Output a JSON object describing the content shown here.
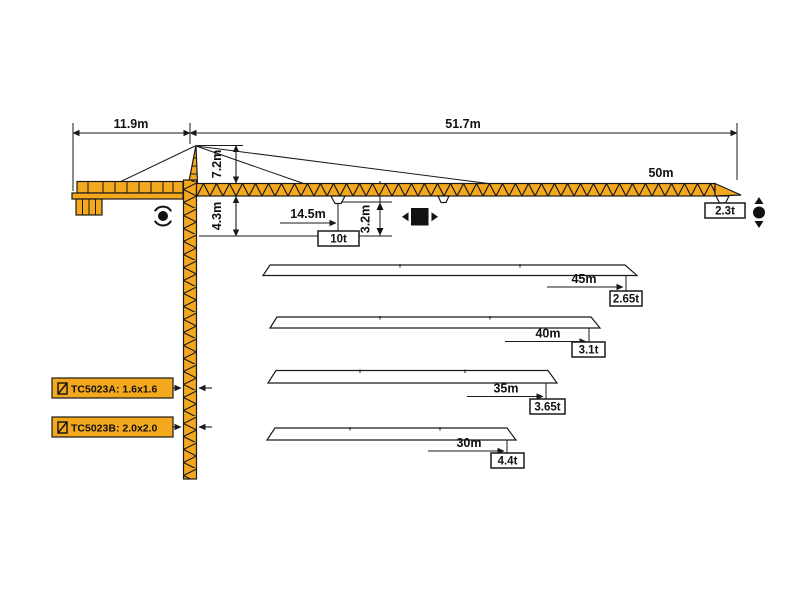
{
  "diagram": {
    "dims": {
      "counter_jib_radius": "11.9m",
      "working_radius": "51.7m",
      "tower_head_height": "7.2m",
      "jib_underside_height": "4.3m",
      "min_radius": "14.5m",
      "hook_path_height": "3.2m"
    },
    "main_jib": {
      "length_label": "50m",
      "max_capacity": "10t",
      "tip_capacity": "2.3t"
    },
    "jib_variants": [
      {
        "length_label": "45m",
        "tip_capacity": "2.65t"
      },
      {
        "length_label": "40m",
        "tip_capacity": "3.1t"
      },
      {
        "length_label": "35m",
        "tip_capacity": "3.65t"
      },
      {
        "length_label": "30m",
        "tip_capacity": "4.4t"
      }
    ],
    "mast_sections": [
      {
        "label": "TC5023A: 1.6x1.6"
      },
      {
        "label": "TC5023B: 2.0x2.0"
      }
    ],
    "icons": {
      "slewing": "dot-with-rotation-arcs",
      "trolley_travel": "black-square-with-left-right-arrows",
      "hoist": "black-circle-with-up-down-arrows",
      "mast_section": "small-square-with-diagonal"
    },
    "colors": {
      "crane": "#F4A81D",
      "outline": "#1a1a1a",
      "background": "#ffffff"
    }
  }
}
